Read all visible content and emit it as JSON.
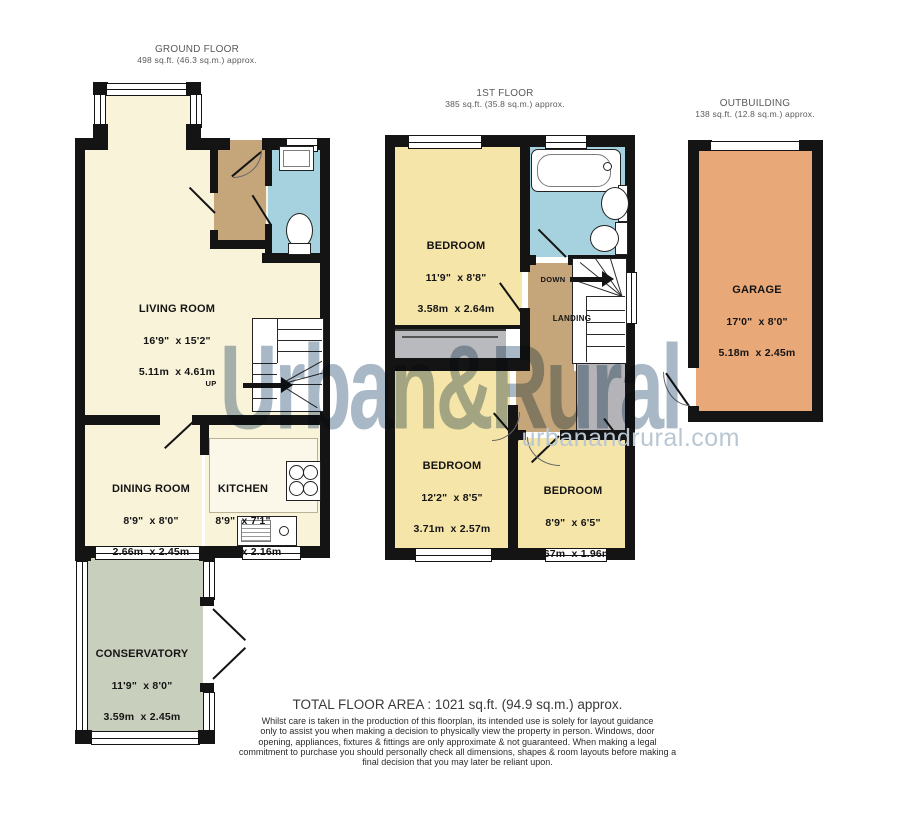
{
  "floors": {
    "ground": {
      "title": "GROUND FLOOR",
      "area": "498 sq.ft. (46.3 sq.m.) approx."
    },
    "first": {
      "title": "1ST FLOOR",
      "area": "385 sq.ft. (35.8 sq.m.) approx."
    },
    "outbuilding": {
      "title": "OUTBUILDING",
      "area": "138 sq.ft. (12.8 sq.m.) approx."
    }
  },
  "rooms": {
    "living": {
      "name": "LIVING ROOM",
      "imperial": "16'9\"  x 15'2\"",
      "metric": "5.11m  x 4.61m"
    },
    "dining": {
      "name": "DINING ROOM",
      "imperial": "8'9\"  x 8'0\"",
      "metric": "2.66m  x 2.45m"
    },
    "kitchen": {
      "name": "KITCHEN",
      "imperial": "8'9\"  x 7'1\"",
      "metric": "2.66m  x 2.16m"
    },
    "conservatory": {
      "name": "CONSERVATORY",
      "imperial": "11'9\"  x 8'0\"",
      "metric": "3.59m  x 2.45m"
    },
    "bedroom1": {
      "name": "BEDROOM",
      "imperial": "11'9\"  x 8'8\"",
      "metric": "3.58m  x 2.64m"
    },
    "bedroom2": {
      "name": "BEDROOM",
      "imperial": "12'2\"  x 8'5\"",
      "metric": "3.71m  x 2.57m"
    },
    "bedroom3": {
      "name": "BEDROOM",
      "imperial": "8'9\"  x 6'5\"",
      "metric": "2.67m  x 1.96m"
    },
    "garage": {
      "name": "GARAGE",
      "imperial": "17'0\"  x 8'0\"",
      "metric": "5.18m  x 2.45m"
    },
    "landing": {
      "name": "LANDING"
    }
  },
  "stairs": {
    "up": "UP",
    "down": "DOWN"
  },
  "watermark": {
    "name": "Urban&Rural",
    "site": "urbanandrural.com"
  },
  "footer": {
    "total": "TOTAL FLOOR AREA : 1021 sq.ft. (94.9 sq.m.) approx.",
    "line1": "Whilst care is taken in the production of this floorplan, its intended use is solely for layout guidance",
    "line2": "only to assist you  when making a decision to physically view the property in person. Windows, door",
    "line3": "opening, appliances, fixtures  & fittings are only approximate & not guaranteed. When making a legal",
    "line4": "commitment to purchase you should personally check all dimensions, shapes & room layouts before making a",
    "line5": "final decision that you may later be reliant upon."
  },
  "colors": {
    "wall": "#141414",
    "ground_rooms": "#f9f3da",
    "bedrooms": "#f6e5a8",
    "hall_landing": "#c5a67b",
    "bathroom": "#a5d2de",
    "conservatory": "#c9cfbd",
    "garage": "#e9a878",
    "storage_gray": "#b9babd",
    "watermark": "#a9b8c6"
  }
}
